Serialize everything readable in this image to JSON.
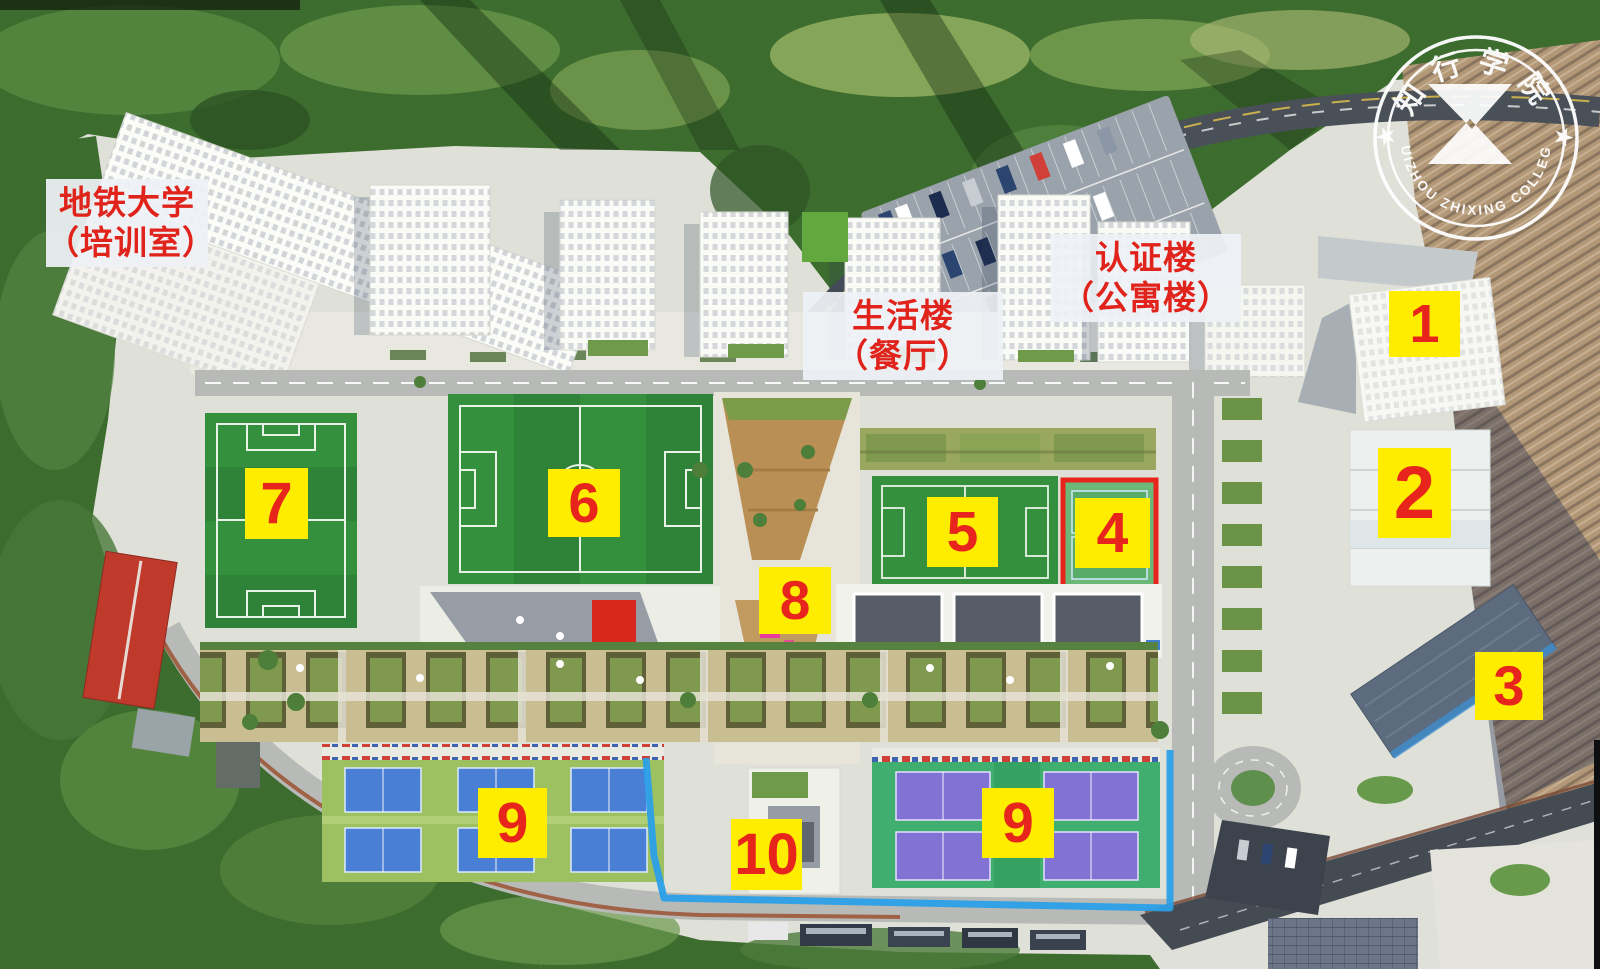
{
  "map": {
    "type": "campus-aerial-map",
    "college": {
      "name_cn": "知行学院",
      "name_en": "HUIZHOU ZHIXING COLLEGE",
      "star_glyph": "★"
    },
    "colors": {
      "marker_bg": "#ffed00",
      "marker_text": "#e8251d",
      "label_bg": "#eef1f5",
      "label_text": "#e0241c",
      "field_green": "#35903d",
      "tennis_blue": "#4a7fd6",
      "tennis_purple": "#8172d4",
      "court4_border": "#e8251d",
      "fence_blue": "#2b9fe8"
    },
    "building_labels": [
      {
        "id": "label-metro-university",
        "line1": "地铁大学",
        "line2": "（培训室）",
        "box": {
          "x": 46,
          "y": 179,
          "w": 162,
          "h": 88
        }
      },
      {
        "id": "label-life-building",
        "line1": "生活楼",
        "line2": "（餐厅）",
        "box": {
          "x": 803,
          "y": 292,
          "w": 200,
          "h": 88
        }
      },
      {
        "id": "label-certification-building",
        "line1": "认证楼",
        "line2": "（公寓楼）",
        "box": {
          "x": 1051,
          "y": 234,
          "w": 190,
          "h": 88
        }
      }
    ],
    "markers": [
      {
        "id": "marker-1",
        "number": "1",
        "box": {
          "x": 1389,
          "y": 291,
          "w": 71,
          "h": 66
        }
      },
      {
        "id": "marker-2",
        "number": "2",
        "box": {
          "x": 1378,
          "y": 448,
          "w": 73,
          "h": 90
        }
      },
      {
        "id": "marker-3",
        "number": "3",
        "box": {
          "x": 1475,
          "y": 652,
          "w": 68,
          "h": 68
        }
      },
      {
        "id": "marker-4",
        "number": "4",
        "box": {
          "x": 1075,
          "y": 498,
          "w": 75,
          "h": 70
        }
      },
      {
        "id": "marker-5",
        "number": "5",
        "box": {
          "x": 927,
          "y": 497,
          "w": 71,
          "h": 70
        }
      },
      {
        "id": "marker-6",
        "number": "6",
        "box": {
          "x": 548,
          "y": 469,
          "w": 72,
          "h": 68
        }
      },
      {
        "id": "marker-7",
        "number": "7",
        "box": {
          "x": 245,
          "y": 468,
          "w": 63,
          "h": 71
        }
      },
      {
        "id": "marker-8",
        "number": "8",
        "box": {
          "x": 759,
          "y": 567,
          "w": 72,
          "h": 67
        }
      },
      {
        "id": "marker-9-west",
        "number": "9",
        "box": {
          "x": 478,
          "y": 788,
          "w": 69,
          "h": 70
        }
      },
      {
        "id": "marker-10",
        "number": "10",
        "box": {
          "x": 731,
          "y": 819,
          "w": 71,
          "h": 71
        }
      },
      {
        "id": "marker-9-east",
        "number": "9",
        "box": {
          "x": 982,
          "y": 788,
          "w": 72,
          "h": 70
        }
      }
    ]
  }
}
